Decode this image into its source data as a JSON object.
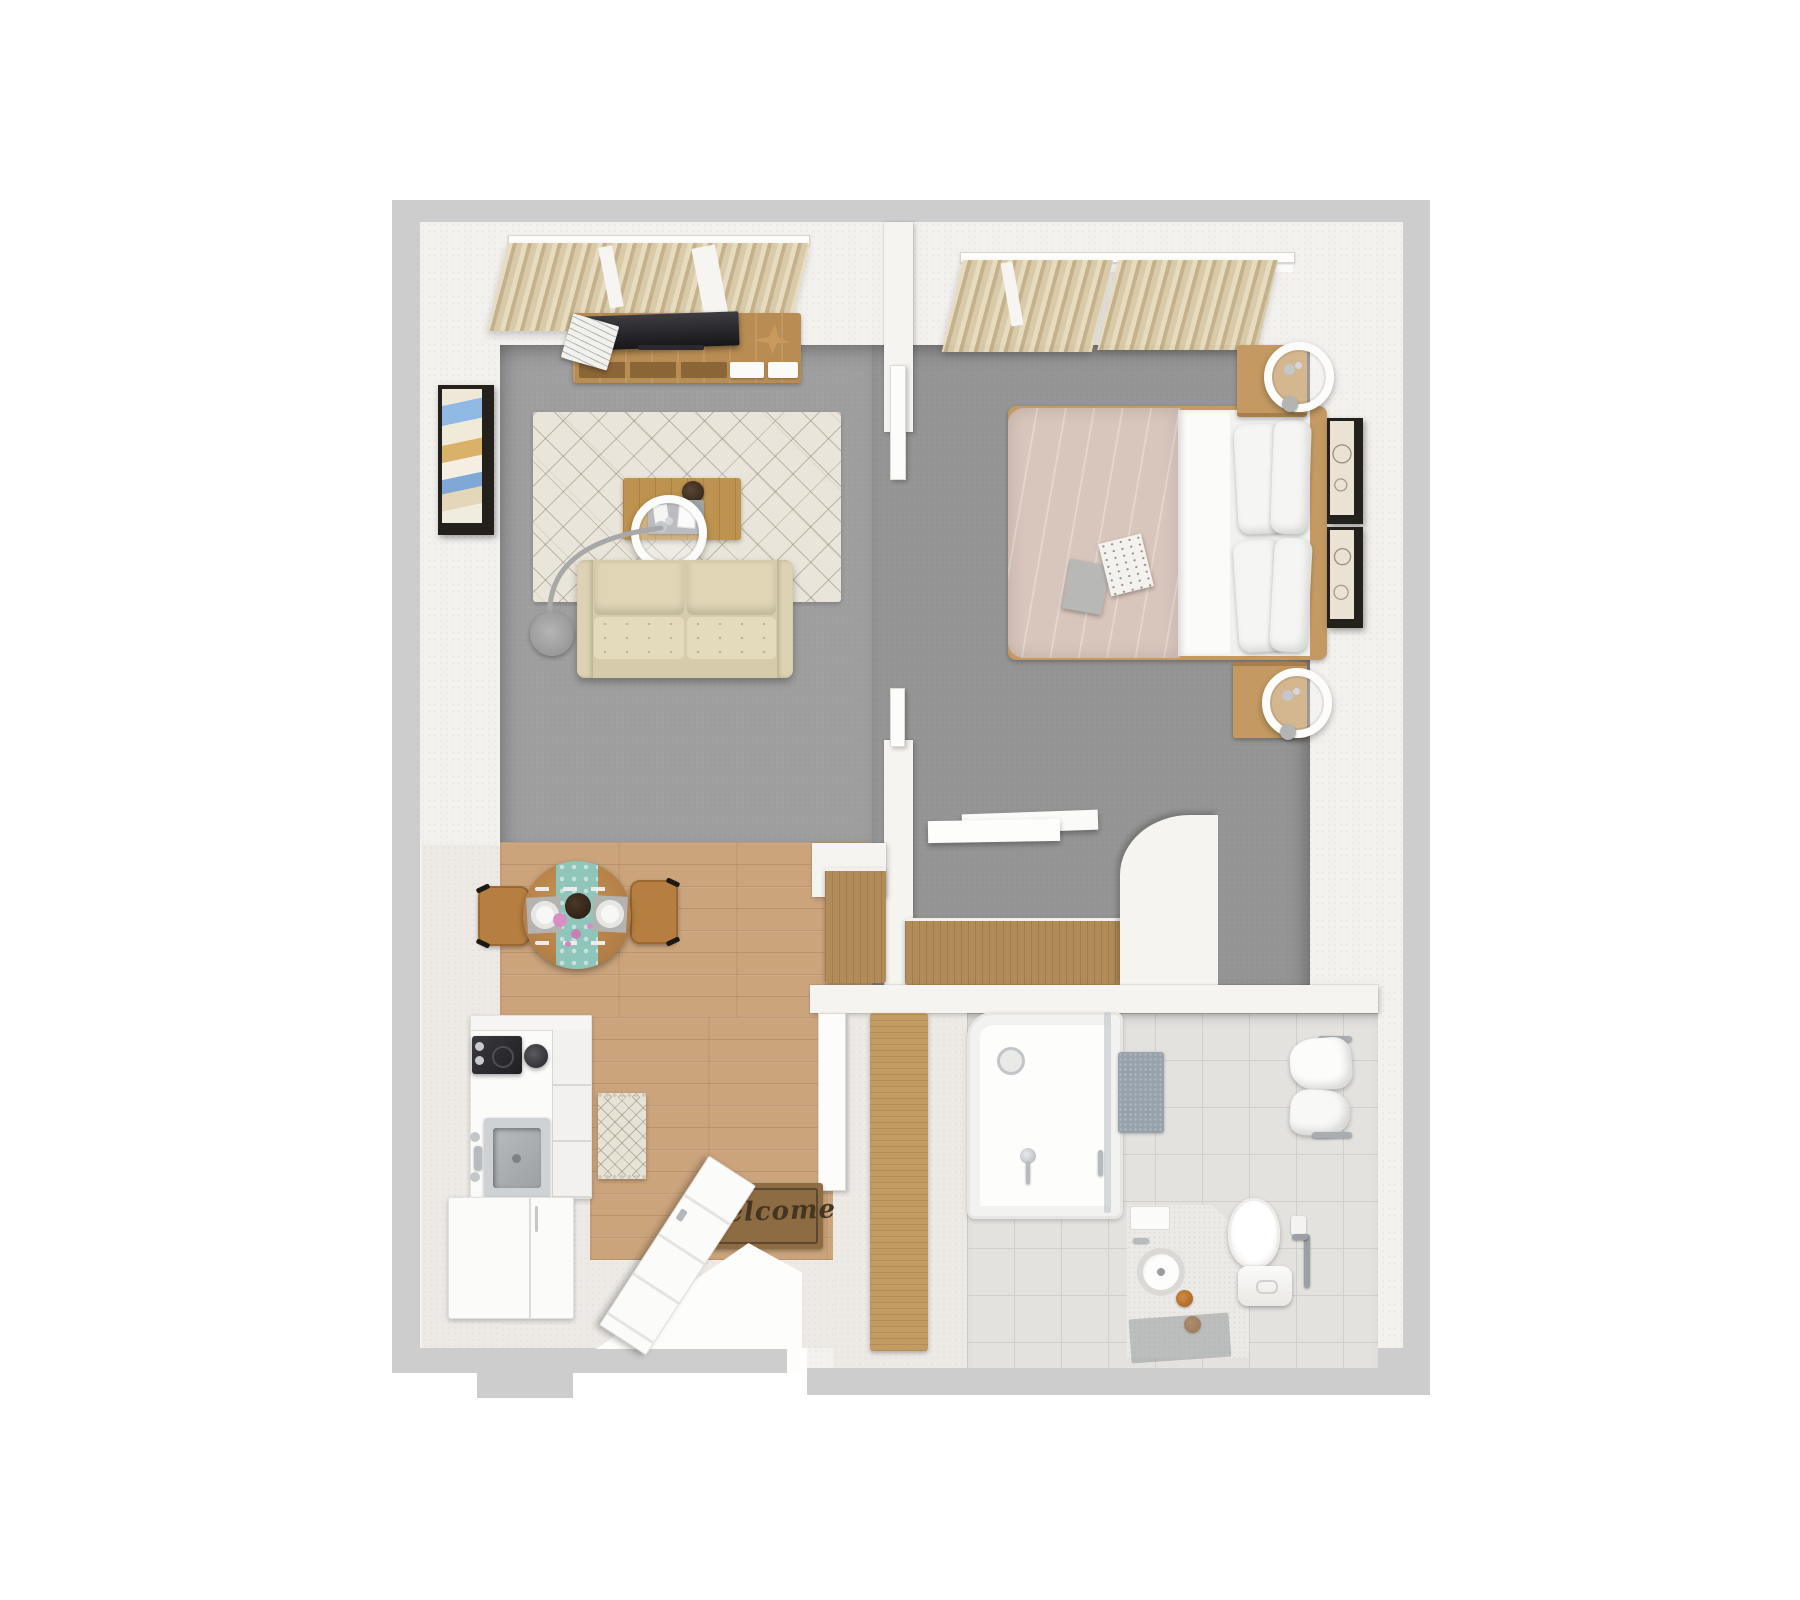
{
  "title": "3D apartment floor plan, top-down render",
  "mat": {
    "text": "welcome"
  },
  "palette": {
    "background": "#ffffff",
    "outer_wall_edge": "#cdcdcd",
    "wall_surface": "#f3f1ee",
    "carpet_living": "#9e9e9e",
    "carpet_bedroom": "#949494",
    "wood_floor": "#cba47c",
    "pale_floor": "#edeae6",
    "bathroom_tile": "#e3e2df",
    "curtain_beige": "#d9c9a7",
    "sofa_beige": "#dcd2b0",
    "rug_cream": "#e9e5da",
    "duvet_blush": "#d8c5bc",
    "furniture_wood": "#b88c52",
    "runner_teal": "#8fc5ba",
    "doormat_brown": "#8d6c44",
    "chrome": "#b7bbbf",
    "bottle_amber": "#bf7a35",
    "tv_screen": "#26262b"
  },
  "rooms": [
    {
      "name": "living-room",
      "floor": "gray-carpet",
      "items": [
        "window-curtains",
        "curtain-rod",
        "tv-console",
        "flatscreen-tv",
        "magazine-stack",
        "bird-decor",
        "wall-art-abstract",
        "patterned-area-rug",
        "coffee-table",
        "ring-table-lamp",
        "arc-floor-lamp",
        "loveseat-sofa"
      ]
    },
    {
      "name": "bedroom",
      "floor": "gray-carpet",
      "items": [
        "window-curtains",
        "curtain-rod",
        "double-bed",
        "blush-duvet",
        "folded-sheet",
        "four-pillows",
        "bedside-books",
        "nightstand-top",
        "nightstand-bottom",
        "ring-bedside-lamps",
        "two-wall-frames",
        "wall-shelf-desk",
        "closet-dresser",
        "sliding-partition-doors"
      ]
    },
    {
      "name": "dining-area",
      "floor": "wood",
      "items": [
        "round-dining-table",
        "teal-table-runner",
        "two-place-settings",
        "flower-vase",
        "two-wood-chairs"
      ]
    },
    {
      "name": "kitchen",
      "floor": "pale",
      "items": [
        "counter-block",
        "cooktop",
        "coffee-maker",
        "inset-sink",
        "drawer-stack",
        "refrigerator",
        "diamond-runner-rug"
      ]
    },
    {
      "name": "entry",
      "floor": "pale-and-wood",
      "items": [
        "open-entry-door",
        "door-swing",
        "welcome-mat",
        "tall-wood-cabinet",
        "pocket-door",
        "threshold"
      ]
    },
    {
      "name": "bathroom",
      "floor": "tile",
      "items": [
        "walk-in-shower",
        "shower-glass",
        "floor-drain",
        "shower-fixture",
        "gray-bath-mat",
        "corner-vanity",
        "round-basin",
        "amber-bottles",
        "vanity-mat",
        "toilet",
        "toilet-tank",
        "paper-holder",
        "grab-bar",
        "towel-rails",
        "hanging-towels"
      ]
    }
  ]
}
